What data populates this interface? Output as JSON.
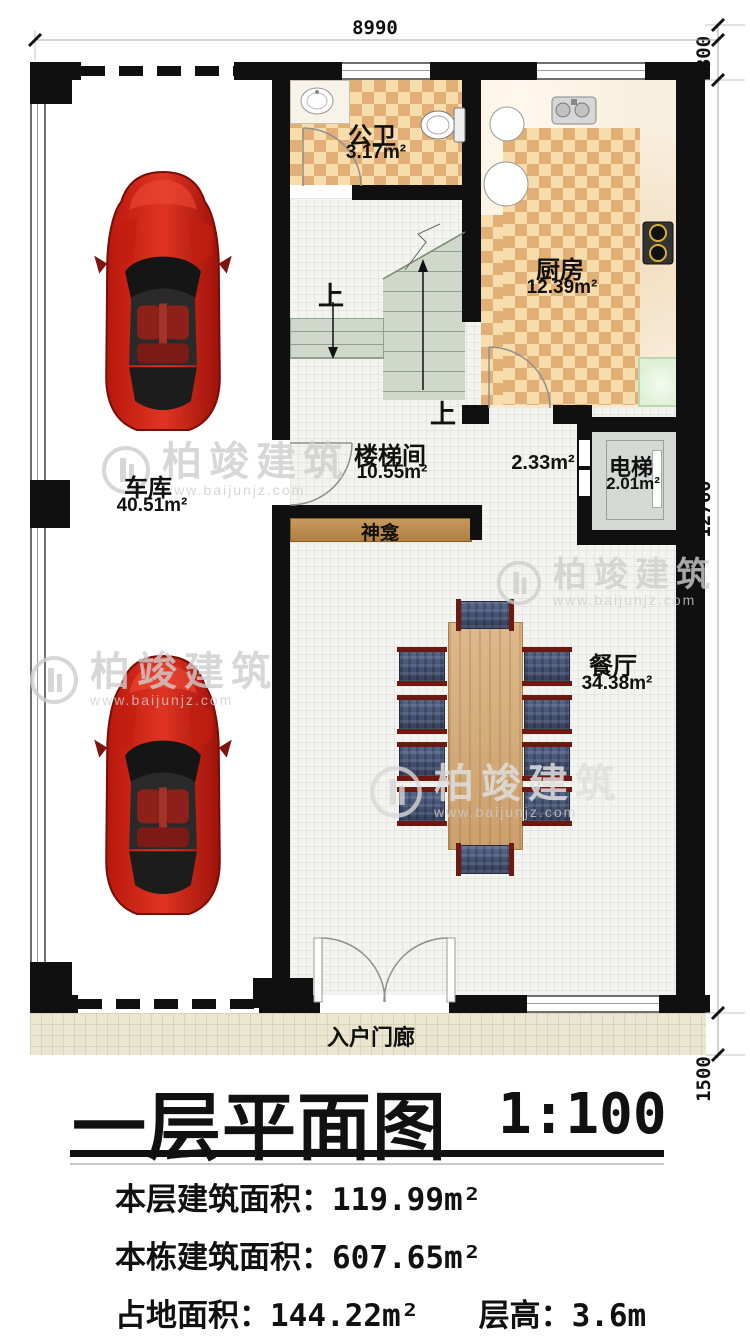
{
  "watermark": {
    "brand": "柏竣建筑",
    "url": "www.baijunjz.com"
  },
  "dimensions": {
    "top_width": "8990",
    "right_offset": "800",
    "right_height": "12760",
    "right_porch": "1500"
  },
  "rooms": {
    "garage": {
      "name": "车库",
      "area": "40.51m²"
    },
    "bathroom": {
      "name": "公卫",
      "area": "3.17m²"
    },
    "kitchen": {
      "name": "厨房",
      "area": "12.39m²"
    },
    "stairwell": {
      "name": "楼梯间",
      "area": "10.55m²"
    },
    "hallway": {
      "area": "2.33m²"
    },
    "elevator": {
      "name": "电梯",
      "area": "2.01m²"
    },
    "shrine": {
      "name": "神龛"
    },
    "dining": {
      "name": "餐厅",
      "area": "34.38m²"
    },
    "porch": {
      "name": "入户门廊"
    }
  },
  "stairs": {
    "up_label_1": "上",
    "up_label_2": "上"
  },
  "title": {
    "name": "一层平面图",
    "scale": "1:100"
  },
  "stats": {
    "floor_area_label": "本层建筑面积：",
    "floor_area_value": "119.99m²",
    "building_area_label": "本栋建筑面积：",
    "building_area_value": "607.65m²",
    "land_area_label": "占地面积：",
    "land_area_value": "144.22m²",
    "height_label": "层高：",
    "height_value": "3.6m"
  }
}
